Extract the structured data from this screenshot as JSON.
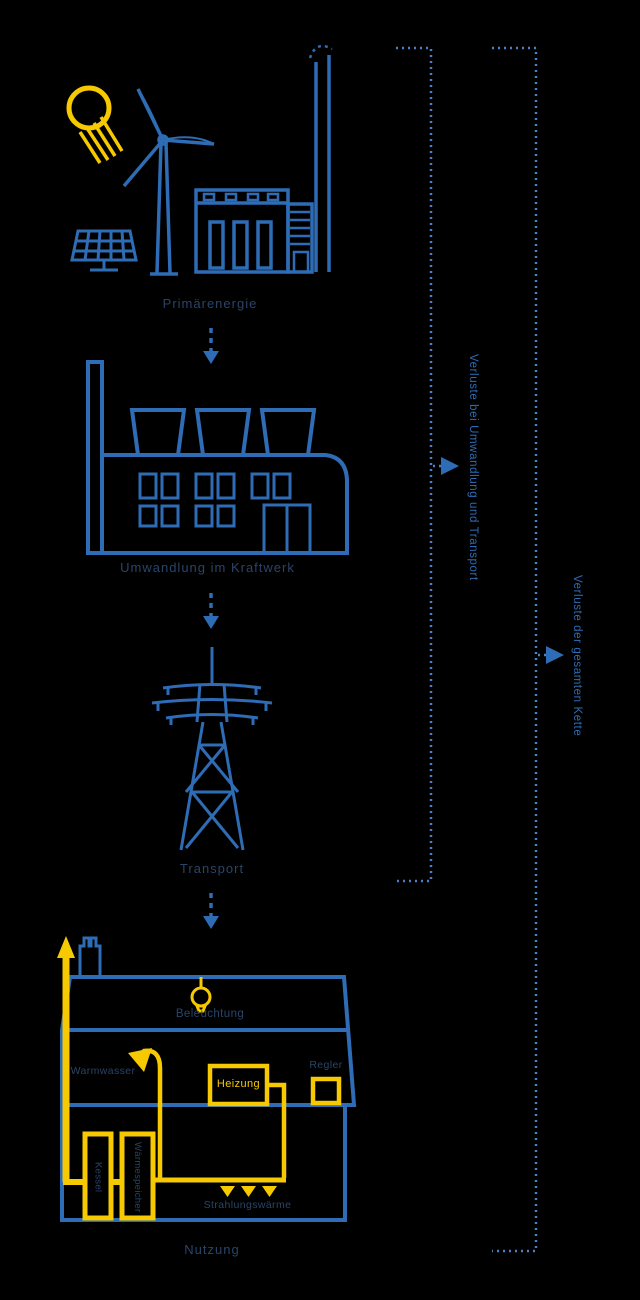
{
  "colors": {
    "background": "#000000",
    "line_blue": "#2e6cb5",
    "accent_yellow": "#f6c900",
    "caption_navy": "#2a4468",
    "dotted_blue": "#4a80c4"
  },
  "stages": [
    {
      "label": "Primärenergie"
    },
    {
      "label": "Umwandlung im Kraftwerk"
    },
    {
      "label": "Transport"
    },
    {
      "label": "Nutzung"
    }
  ],
  "house": {
    "lighting_label": "Beleuchtung",
    "hot_water_label": "Warmwasser",
    "heating_label": "Heizung",
    "controller_label": "Regler",
    "boiler_label": "Kessel",
    "storage_label": "Wärmespeicher",
    "radiant_heat_label": "Strahlungswärme"
  },
  "annotations": {
    "losses_conversion_transport": "Verluste bei Umwandlung und Transport",
    "losses_total": "Verluste der gesamten Kette"
  },
  "icons": [
    "sun-icon",
    "wind-turbine-icon",
    "solar-panel-icon",
    "power-station-icon",
    "factory-icon",
    "pylon-icon",
    "house-icon",
    "chimney-icon",
    "light-bulb-icon",
    "shower-icon",
    "heater-box-icon",
    "control-box-icon",
    "boiler-icon",
    "storage-tank-icon",
    "radiant-heat-icon",
    "flow-arrow-icon",
    "bracket-icon"
  ]
}
